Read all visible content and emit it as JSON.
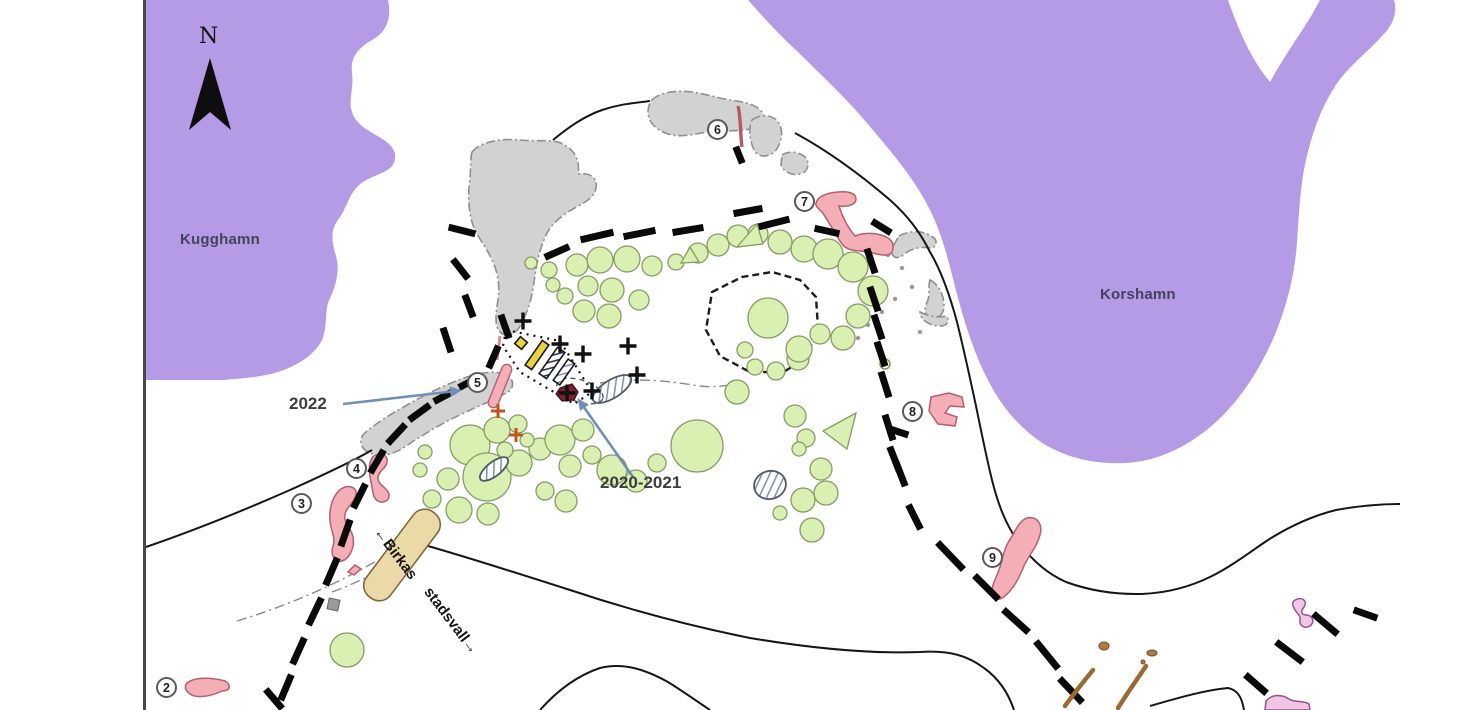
{
  "title": "Birka harbour area excavation plan",
  "labels": {
    "north": "N",
    "bay_west": "Kugghamn",
    "bay_east": "Korshamn",
    "year_2022": "2022",
    "year_2020_2021": "2020-2021",
    "wall_label_1": "←Birkas",
    "wall_label_2": "stadsvall→"
  },
  "markers": [
    {
      "label": "2",
      "x": 167,
      "y": 688
    },
    {
      "label": "3",
      "x": 302,
      "y": 504
    },
    {
      "label": "4",
      "x": 357,
      "y": 469
    },
    {
      "label": "5",
      "x": 478,
      "y": 383
    },
    {
      "label": "6",
      "x": 718,
      "y": 130
    },
    {
      "label": "7",
      "x": 805,
      "y": 202
    },
    {
      "label": "8",
      "x": 913,
      "y": 412
    },
    {
      "label": "9",
      "x": 993,
      "y": 558
    }
  ],
  "colors": {
    "water": "#b59ae5",
    "water_label": "#45425f",
    "mound_fill": "#daf0b2",
    "mound_stroke": "#879b66",
    "trench_fill": "#f3aeb6",
    "trench_stroke": "#b55f6e",
    "rock_fill": "#d2d2d2",
    "rock_stroke": "#8f8f8f",
    "rampart_dash": "#0a0a0a",
    "wall_band_fill": "#ebdaa7",
    "wall_band_stroke": "#7c6a3e",
    "cross_black": "#111111",
    "cross_orange": "#c0571a",
    "dark_red": "#7d1f30",
    "hatch_blue": "#7e95b5",
    "stripe_navy": "#2a3560",
    "arrow_blue": "#6f8fb4",
    "wood_brown": "#9a6a33",
    "squiggle_fill": "#f0c6e4",
    "squiggle_stroke": "#96538f",
    "yellow_bar": "#e8d23f",
    "contour": "#161616",
    "border": "#4a4a4a"
  },
  "map": {
    "water_west_path": "M146,0 L388,0 C392,20 386,32 372,40 C358,48 350,58 352,72 C354,90 348,100 352,112 C356,126 372,132 384,140 C396,148 398,158 392,166 C386,174 368,176 358,186 C348,196 346,210 338,220 C330,230 332,244 336,256 C340,270 336,286 330,298 C324,310 328,326 322,340 C314,356 296,366 278,372 C258,378 240,378 224,380 L146,380 Z",
    "water_east_path": "M748,0 L1228,0 C1238,28 1250,58 1270,82 C1282,60 1296,40 1310,18 L1320,0 L1394,0 C1398,14 1392,26 1382,36 C1366,54 1346,68 1334,88 C1320,110 1312,134 1306,160 C1300,186 1299,214 1297,242 C1295,272 1288,302 1276,332 C1262,366 1242,398 1216,422 C1194,442 1166,458 1136,462 C1104,466 1070,460 1044,444 C1022,430 1004,410 990,384 C976,358 966,328 958,298 C950,268 944,238 930,210 C914,178 890,150 866,122 C846,98 822,76 798,52 C780,36 764,18 748,0 Z",
    "rocks": [
      "M472,152 C480,142 500,138 520,140 C540,142 556,138 566,146 C576,152 580,162 578,174 C590,172 598,178 596,188 C594,200 580,204 568,212 C556,220 548,228 544,240 C538,254 536,268 534,282 C532,298 528,312 520,326 C516,334 506,338 500,332 C494,326 496,312 498,300 C500,286 498,272 492,260 C486,246 476,236 472,222 C468,208 468,192 470,178 C471,168 470,160 472,152 Z",
      "M368,452 C360,448 358,438 366,432 C380,420 398,410 416,400 C434,390 452,382 470,376 C484,372 498,370 508,376 C514,380 514,388 508,392 C494,400 478,406 462,414 C444,422 428,432 412,442 C398,452 384,460 368,452 Z",
      "M652,100 C660,92 676,90 692,92 C706,94 718,98 730,100 C744,102 756,104 762,112 C766,118 762,126 754,128 C740,132 724,130 708,132 C694,134 680,138 668,134 C656,130 648,122 648,112 C648,106 650,103 652,100 Z",
      "M752,120 C760,114 772,114 778,122 C784,130 782,142 776,150 C770,158 758,158 754,150 C750,142 748,128 752,120 Z",
      "M782,155 C790,150 800,152 806,158 C810,164 808,172 800,174 C792,176 784,172 781,165 Z",
      "M899,236 C910,230 924,230 934,238 C938,242 936,248 930,248 C918,246 908,250 902,256 C896,260 890,256 892,248 Z",
      "M930,280 C938,284 944,294 944,306 C944,314 938,320 930,318 C924,316 924,308 928,300 C930,292 928,286 930,280 Z",
      "M920,312 C928,316 938,318 946,316 C950,320 948,326 940,326 C930,326 920,320 920,312 Z"
    ],
    "rock_square": {
      "x": 328,
      "y": 599,
      "w": 11,
      "h": 11,
      "rot": 12
    },
    "gray_dots": [
      [
        902,
        268
      ],
      [
        912,
        287
      ],
      [
        895,
        299
      ],
      [
        882,
        312
      ],
      [
        868,
        325
      ],
      [
        858,
        338
      ],
      [
        888,
        255
      ],
      [
        920,
        332
      ]
    ],
    "contours": [
      "M143,548 C190,532 240,512 290,490 C330,472 355,460 372,450",
      "M553,140 C570,126 585,116 602,110 C620,104 634,103 650,101",
      "M795,133 C830,152 862,176 890,200 C908,216 920,232 930,252 C942,272 950,296 957,322 C964,350 970,378 976,406 C981,430 986,456 992,480 C998,504 1006,526 1020,544 C1032,560 1048,574 1066,582 C1088,590 1112,594 1136,594 C1162,594 1188,588 1212,576 C1232,566 1250,552 1268,540 C1290,526 1312,516 1336,510 C1358,506 1380,504 1400,504",
      "M428,546 C470,558 520,574 570,590 C630,610 690,626 750,638 C810,648 870,654 920,652 C950,650 968,656 984,668 C998,678 1008,692 1014,710",
      "M540,710 C556,692 576,676 600,668 C624,662 646,670 668,682 C684,692 698,702 710,710",
      "M1150,706 C1178,698 1205,690 1228,688 C1238,690 1242,698 1244,710"
    ],
    "enclosure_loop": "M712,292 L742,277 L772,272 L800,280 L816,297 L818,328 L806,358 L782,373 L748,371 L720,356 L706,330 Z",
    "dashdot_lines": [
      "M237,621 C280,608 330,588 378,560",
      "M332,592 C360,582 390,566 418,548",
      "M600,383 C636,377 668,381 700,386 C716,388 728,385 742,383"
    ],
    "mounds": [
      [
        577,
        265,
        11
      ],
      [
        600,
        260,
        13
      ],
      [
        627,
        259,
        13
      ],
      [
        652,
        266,
        10
      ],
      [
        676,
        262,
        8
      ],
      [
        698,
        253,
        10
      ],
      [
        718,
        245,
        11
      ],
      [
        738,
        236,
        11
      ],
      [
        758,
        234,
        10
      ],
      [
        780,
        242,
        12
      ],
      [
        804,
        249,
        13
      ],
      [
        828,
        254,
        15
      ],
      [
        853,
        267,
        15
      ],
      [
        873,
        291,
        15
      ],
      [
        858,
        316,
        12
      ],
      [
        843,
        338,
        12
      ],
      [
        820,
        334,
        10
      ],
      [
        798,
        359,
        11
      ],
      [
        776,
        371,
        9
      ],
      [
        755,
        367,
        8
      ],
      [
        549,
        270,
        8
      ],
      [
        531,
        263,
        6
      ],
      [
        588,
        286,
        10
      ],
      [
        612,
        290,
        12
      ],
      [
        639,
        300,
        10
      ],
      [
        609,
        316,
        12
      ],
      [
        584,
        311,
        11
      ],
      [
        565,
        296,
        8
      ],
      [
        553,
        285,
        7
      ],
      [
        768,
        318,
        20
      ],
      [
        799,
        349,
        13
      ],
      [
        745,
        350,
        8
      ],
      [
        470,
        445,
        20
      ],
      [
        497,
        430,
        13
      ],
      [
        518,
        424,
        9
      ],
      [
        487,
        477,
        24
      ],
      [
        519,
        463,
        13
      ],
      [
        540,
        449,
        11
      ],
      [
        560,
        440,
        15
      ],
      [
        583,
        430,
        11
      ],
      [
        448,
        479,
        11
      ],
      [
        432,
        499,
        9
      ],
      [
        459,
        510,
        13
      ],
      [
        488,
        514,
        11
      ],
      [
        570,
        466,
        11
      ],
      [
        592,
        455,
        9
      ],
      [
        612,
        470,
        15
      ],
      [
        636,
        481,
        11
      ],
      [
        657,
        463,
        9
      ],
      [
        545,
        491,
        9
      ],
      [
        566,
        501,
        11
      ],
      [
        420,
        470,
        7
      ],
      [
        527,
        440,
        7
      ],
      [
        505,
        450,
        8
      ],
      [
        425,
        452,
        7
      ],
      [
        697,
        446,
        26
      ],
      [
        737,
        392,
        12
      ],
      [
        795,
        416,
        11
      ],
      [
        806,
        438,
        9
      ],
      [
        826,
        493,
        12
      ],
      [
        803,
        500,
        12
      ],
      [
        780,
        513,
        7
      ],
      [
        812,
        530,
        12
      ],
      [
        821,
        469,
        11
      ],
      [
        799,
        449,
        7
      ],
      [
        347,
        650,
        17
      ]
    ],
    "mound_ring": [
      885,
      364,
      5
    ],
    "triangles": [
      [
        757,
        224,
        737,
        247,
        763,
        244
      ],
      [
        690,
        247,
        681,
        263,
        699,
        262
      ],
      [
        856,
        413,
        823,
        431,
        847,
        449
      ]
    ],
    "wall_band": {
      "cx": 402,
      "cy": 555,
      "w": 30,
      "h": 106,
      "rot": 37
    },
    "trenches": [
      "M187,683 C196,676 214,678 225,681 C231,684 231,691 222,691 C212,696 197,699 190,694 C185,690 184,687 187,683 Z",
      "M341,489 C349,484 357,487 356,495 C355,502 347,506 345,514 C343,523 351,527 353,537 C355,548 349,559 342,561 C335,563 330,555 333,546 C336,538 331,531 330,521 C329,507 333,495 341,489 Z",
      "M374,456 C381,452 388,455 387,462 C386,469 379,470 378,477 C377,485 387,487 389,494 C390,500 384,504 378,501 C372,498 373,489 371,482 C369,473 368,461 374,456 Z",
      "M816,203 C818,196 826,193 838,192 C848,191 856,193 856,199 C856,205 848,207 839,206 C842,216 848,228 855,236 C862,233 874,232 884,236 C892,239 895,245 892,252 C888,258 878,254 868,252 C858,250 848,252 842,244 C835,234 828,220 822,212 C818,208 815,206 816,203 Z",
      "M931,397 L949,393 L962,397 L964,407 L950,406 L945,413 L957,417 L955,426 L938,424 L929,411 Z",
      "M1027,518 C1037,516 1043,524 1040,535 C1036,549 1028,556 1024,566 C1019,578 1014,588 1006,595 C1000,601 993,601 992,594 C991,585 997,577 1000,567 C1003,556 1005,546 1011,538 C1016,530 1019,521 1027,518 Z",
      "M348,572 L355,565 L361,569 L354,575 Z"
    ],
    "trench5_bar": {
      "cx": 500,
      "cy": 386,
      "w": 10,
      "h": 46,
      "rot": 22
    },
    "trench5_line": [
      500,
      336,
      497,
      360
    ],
    "trench6_line": "M738,106 C741,118 740,132 742,147",
    "rampart_dashes": [
      [
        282,
        697,
        290,
        678
      ],
      [
        294,
        661,
        303,
        641
      ],
      [
        310,
        622,
        320,
        601
      ],
      [
        327,
        582,
        336,
        561
      ],
      [
        342,
        543,
        349,
        523
      ],
      [
        355,
        505,
        364,
        487
      ],
      [
        372,
        470,
        382,
        453
      ],
      [
        390,
        441,
        403,
        427
      ],
      [
        412,
        418,
        427,
        407
      ],
      [
        437,
        400,
        452,
        392
      ],
      [
        462,
        386,
        477,
        378
      ],
      [
        268,
        692,
        280,
        706
      ],
      [
        455,
        262,
        466,
        276
      ],
      [
        466,
        298,
        472,
        314
      ],
      [
        444,
        331,
        450,
        349
      ],
      [
        490,
        365,
        497,
        349
      ],
      [
        502,
        318,
        508,
        335
      ],
      [
        452,
        228,
        472,
        233
      ],
      [
        548,
        256,
        566,
        248
      ],
      [
        584,
        239,
        610,
        233
      ],
      [
        627,
        236,
        652,
        231
      ],
      [
        676,
        232,
        700,
        228
      ],
      [
        737,
        213,
        759,
        209
      ],
      [
        762,
        226,
        786,
        220
      ],
      [
        818,
        229,
        836,
        233
      ],
      [
        875,
        223,
        888,
        231
      ],
      [
        868,
        252,
        874,
        270
      ],
      [
        871,
        290,
        877,
        308
      ],
      [
        875,
        318,
        881,
        336
      ],
      [
        878,
        345,
        884,
        363
      ],
      [
        882,
        375,
        888,
        394
      ],
      [
        886,
        418,
        892,
        437
      ],
      [
        893,
        430,
        905,
        434
      ],
      [
        891,
        450,
        898,
        468
      ],
      [
        897,
        465,
        904,
        483
      ],
      [
        910,
        508,
        919,
        526
      ],
      [
        940,
        545,
        961,
        567
      ],
      [
        977,
        578,
        996,
        597
      ],
      [
        1006,
        612,
        1026,
        630
      ],
      [
        1038,
        644,
        1056,
        666
      ],
      [
        1062,
        681,
        1080,
        700
      ],
      [
        1248,
        677,
        1264,
        691
      ],
      [
        1279,
        644,
        1300,
        660
      ],
      [
        1316,
        616,
        1335,
        632
      ],
      [
        1357,
        611,
        1374,
        617
      ],
      [
        737,
        150,
        741,
        160
      ]
    ],
    "excavation_outline": "506,330 560,341 592,392 574,404 520,372 503,346",
    "excavation_oval": {
      "cx": 580,
      "cy": 391,
      "rx": 24,
      "ry": 11,
      "rot": 18
    },
    "bars": {
      "yellow_square": {
        "cx": 521,
        "cy": 343,
        "w": 9,
        "h": 9,
        "rot": 40
      },
      "yellow_bar": {
        "cx": 537,
        "cy": 355,
        "w": 8,
        "h": 30,
        "rot": 35
      },
      "navy_bar": {
        "cx": 552,
        "cy": 363,
        "w": 9,
        "h": 32,
        "rot": 35
      },
      "blue_bar": {
        "cx": 564,
        "cy": 372,
        "w": 8,
        "h": 26,
        "rot": 35
      }
    },
    "maroon_blob": "M560,388 L572,384 L578,392 L574,400 L562,401 L556,394 Z",
    "hatched_ellipses": [
      {
        "cx": 612,
        "cy": 389,
        "rx": 22,
        "ry": 9,
        "rot": -32
      },
      {
        "cx": 494,
        "cy": 469,
        "rx": 17,
        "ry": 7,
        "rot": -38
      },
      {
        "cx": 770,
        "cy": 485,
        "rx": 16,
        "ry": 14,
        "rot": -15
      }
    ],
    "crosses_black": [
      [
        523,
        321
      ],
      [
        560,
        344
      ],
      [
        583,
        354
      ],
      [
        628,
        346
      ],
      [
        637,
        375
      ],
      [
        592,
        391
      ],
      [
        567,
        393
      ]
    ],
    "crosses_orange": [
      [
        498,
        411
      ],
      [
        516,
        435
      ]
    ],
    "wood_lines": [
      "M1065,706 C1075,692 1084,681 1093,670",
      "M1118,708 C1128,692 1138,678 1146,666"
    ],
    "wood_blobs": [
      [
        1104,
        646,
        5,
        4
      ],
      [
        1152,
        653,
        5,
        3
      ],
      [
        1143,
        662,
        2,
        2
      ]
    ],
    "squiggles": [
      "M1295,600 C1302,596 1308,601 1304,607 C1300,612 1301,615 1307,615 C1313,616 1315,622 1310,626 C1305,629 1299,626 1300,620 C1301,615 1296,613 1294,608 C1292,604 1292,602 1295,600 Z",
      "M1266,701 C1273,693 1283,695 1289,699 C1295,703 1303,700 1309,704 L1310,710 L1265,710 Z"
    ],
    "arrows": [
      {
        "x1": 343,
        "y1": 404,
        "x2": 456,
        "y2": 391
      },
      {
        "x1": 633,
        "y1": 477,
        "x2": 581,
        "y2": 403
      }
    ],
    "north_triangle": "210,58 189,130 210,112 231,130",
    "border_x": 143
  }
}
